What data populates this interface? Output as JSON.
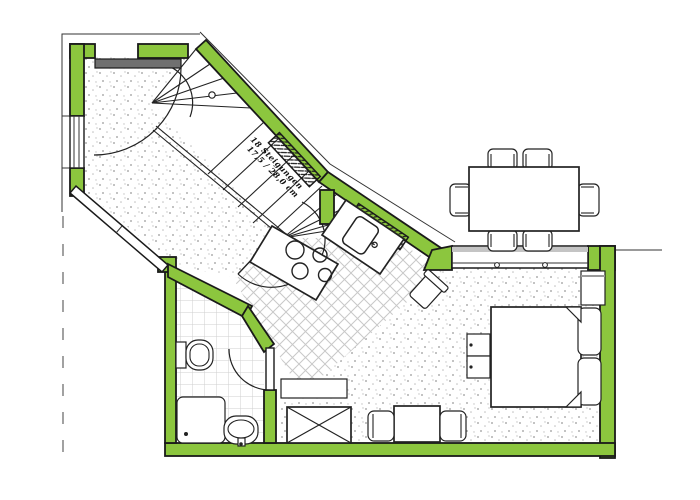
{
  "document": {
    "type": "architectural floor plan",
    "description": "Apartment plan with winder staircase, kitchen, bathroom, bedroom-living room and terrace dining area"
  },
  "stair": {
    "annotation_line1": "18 Steigungen",
    "annotation_line2": "17,5 / 28,0 cm"
  },
  "colors": {
    "wall_green": "#8cc63e",
    "outline": "#1a1a1a",
    "door_leaf_gray": "#707070",
    "sill_gray": "#c4c4c4",
    "texture_dot": "#b0b0b0",
    "tile_line": "#cfcfcf",
    "hatch_line": "#c8c8c8",
    "background": "#ffffff"
  },
  "rooms": {
    "hall": {
      "floor": "stipple"
    },
    "staircase": {
      "treads": 18,
      "type": "winder"
    },
    "kitchen": {
      "floor": "diagonal-tiles",
      "fixtures": [
        "hob-4-burners",
        "sink"
      ]
    },
    "bathroom": {
      "floor": "square-tiles",
      "fixtures": [
        "toilet",
        "shower-tray",
        "washbasin"
      ]
    },
    "living-bedroom": {
      "floor": "stipple",
      "furniture": [
        "double-bed",
        "two-pillows",
        "two-side-stools",
        "wardrobe",
        "sideboard",
        "built-in-cupboard",
        "small-table-with-2-chairs",
        "armchair"
      ]
    },
    "terrace": {
      "furniture": [
        "dining-table-with-6-chairs"
      ]
    }
  },
  "openings": {
    "entry_door": "top wall, swing into hall",
    "bathroom_door": "swing into bathroom",
    "stair_door": "swing into kitchen area",
    "windows": [
      "left wall",
      "hall diagonal band (2 panes)",
      "stair diagonal window",
      "kitchen diagonal window",
      "bedroom 3-pane glazing band"
    ]
  }
}
